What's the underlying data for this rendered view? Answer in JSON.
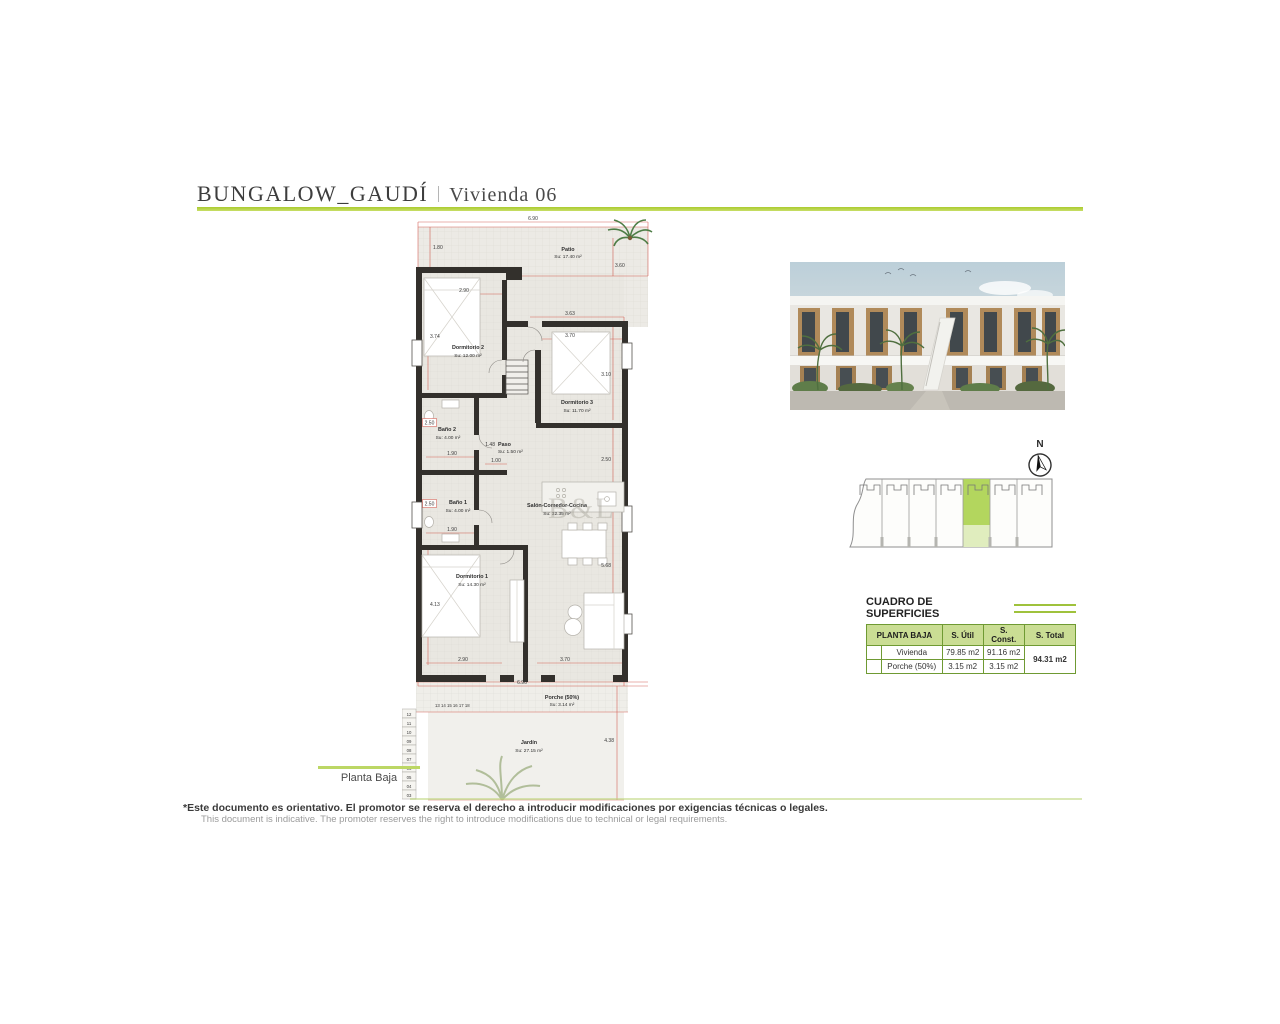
{
  "page": {
    "title_main": "BUNGALOW_GAUDÍ",
    "title_sub": "Vivienda 06",
    "plan_label": "Planta Baja",
    "watermark": "B&L",
    "accent_green": "#aacb2e"
  },
  "floor_plan": {
    "rooms": [
      {
        "name": "Patio",
        "area": "Su: 17.40 m²"
      },
      {
        "name": "Dormitorio 2",
        "area": "Su: 12.00 m²"
      },
      {
        "name": "Dormitorio 3",
        "area": "Su: 11.70 m²"
      },
      {
        "name": "Baño 2",
        "area": "Su: 4.00 m²"
      },
      {
        "name": "Paso",
        "area": "Su: 1.50 m²"
      },
      {
        "name": "Baño 1",
        "area": "Su: 4.00 m²"
      },
      {
        "name": "Salón-Comedor-Cocina",
        "area": "Su: 32.35 m²"
      },
      {
        "name": "Dormitorio 1",
        "area": "Su: 14.30 m²"
      },
      {
        "name": "Porche (50%)",
        "area": "Su: 3.14 m²"
      },
      {
        "name": "Jardín",
        "area": "Su: 27.15 m²"
      }
    ],
    "dimensions": [
      "6.90",
      "1.80",
      "3.60",
      "2.90",
      "3.74",
      "3.63",
      "3.70",
      "3.10",
      "2.50",
      "1.90",
      "1.48",
      "1.00",
      "2.50",
      "2.50",
      "1.90",
      "5.68",
      "4.13",
      "2.90",
      "3.70",
      "6.96",
      "4.38"
    ],
    "stairs": {
      "top_row": "13 14 15 16 17 18",
      "column": [
        "12",
        "11",
        "10",
        "09",
        "08",
        "07",
        "06",
        "05",
        "04",
        "03"
      ]
    }
  },
  "compass": {
    "label": "N"
  },
  "surfaces_table": {
    "title": "CUADRO DE SUPERFICIES",
    "header": [
      "PLANTA BAJA",
      "S. Útil",
      "S. Const.",
      "S. Total"
    ],
    "rows": [
      {
        "name": "Vivienda",
        "util": "79.85 m2",
        "const": "91.16 m2"
      },
      {
        "name": "Porche (50%)",
        "util": "3.15 m2",
        "const": "3.15 m2"
      }
    ],
    "total": "94.31 m2"
  },
  "disclaimer": {
    "es": "*Este documento es orientativo. El promotor se reserva el derecho a introducir modificaciones por exigencias técnicas o legales.",
    "en": "This document is indicative. The promoter reserves the right to introduce modifications due to technical or legal requirements."
  }
}
